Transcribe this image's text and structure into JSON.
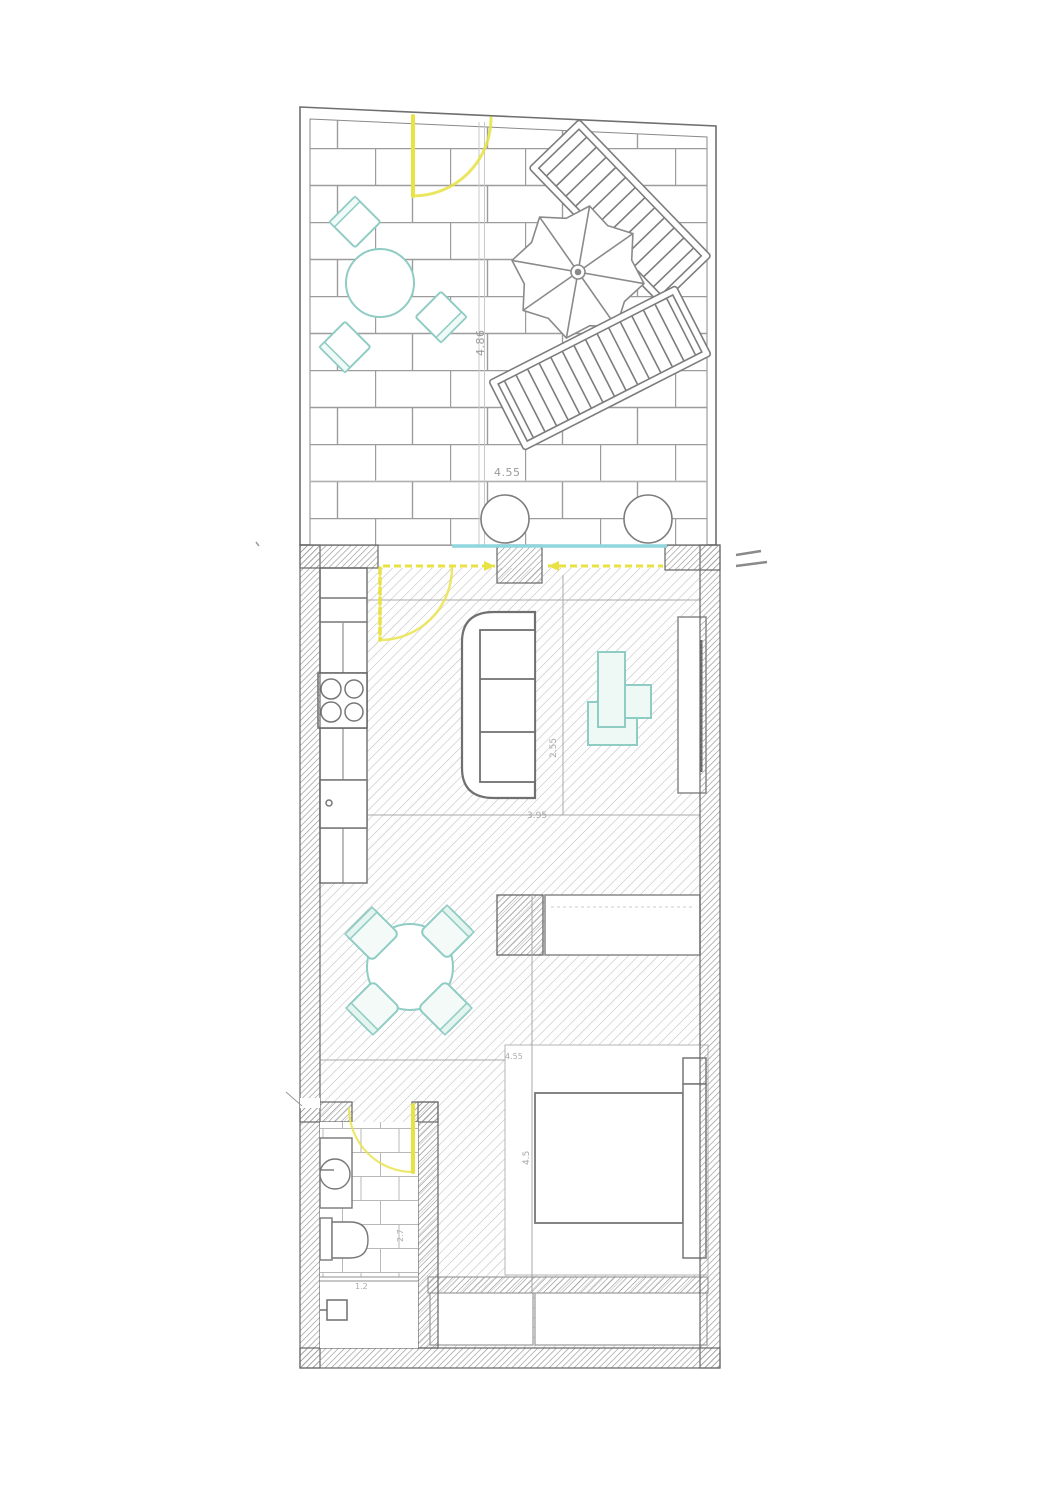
{
  "plan": {
    "type": "apartment-floor-plan-with-roof-terrace",
    "dims": {
      "terrace_depth": "4.86",
      "terrace_width": "4.55",
      "living_width": "3.95",
      "living_depth": "2.55",
      "bedroom_width": "4.55",
      "bedroom_depth": "4.5",
      "bathroom_depth": "2.7",
      "bathroom_width": "1.2"
    },
    "colors": {
      "teal": "#8fccc4",
      "teal_fill": "#eef8f4",
      "yellow": "#e8e244",
      "cyan": "#8fd6de",
      "line": "#6f6f6f",
      "floor_hatch": "#bdbdbd",
      "wall_hatch": "#8d8d8d",
      "paving": "#9c9c9c",
      "background": "#ffffff"
    },
    "rooms": [
      "terrace",
      "kitchen-living-room",
      "dining-area",
      "bedroom",
      "bathroom"
    ],
    "furniture": [
      "terrace-table",
      "terrace-chairs",
      "parasol-umbrella",
      "sun-lounger",
      "sun-lounger",
      "planter",
      "planter",
      "kitchen-counter",
      "cooktop",
      "sofa",
      "desk",
      "desk-chair",
      "wall-unit",
      "dining-table",
      "dining-chairs",
      "wardrobe",
      "bed",
      "headboard",
      "closet",
      "washbasin",
      "toilet",
      "electrical-box"
    ]
  }
}
